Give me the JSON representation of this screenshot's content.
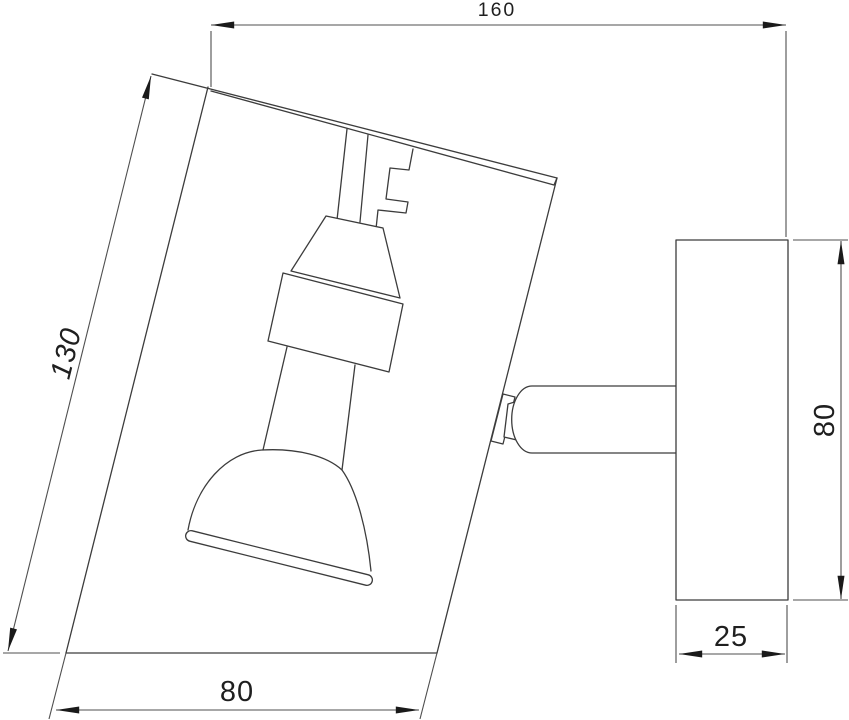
{
  "drawing": {
    "title": "wall spot light — dimensioned line drawing",
    "units": "mm",
    "dimensions": {
      "overall_depth": "160",
      "shade_height": "130",
      "shade_width": "80",
      "plate_height": "80",
      "plate_depth": "25"
    },
    "parts": {
      "shade": "tilted rectangular shade",
      "lamp": "spot lamp with bell reflector",
      "arm": "swivel arm",
      "wall_plate": "wall mounting plate"
    },
    "colors": {
      "background": "#ffffff",
      "part_line": "#3c3c3c",
      "dimension_line": "#4f4f4f",
      "text": "#1f1f1f"
    }
  }
}
